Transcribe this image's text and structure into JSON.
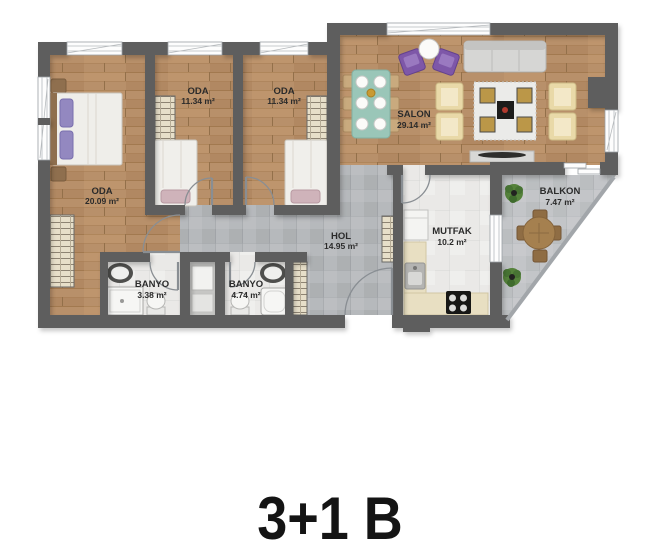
{
  "title": "3+1 B",
  "palette": {
    "wall": "#5e5e5e",
    "wood_floor": "#b8906a",
    "tile_gray": "#b6b9bc",
    "tile_light": "#eae9e7",
    "label_color": "#2b2b2b",
    "accent_purple": "#7e57a8",
    "accent_teal": "#9ac6b8"
  },
  "rooms": [
    {
      "name": "ODA",
      "area": "20.09 m²"
    },
    {
      "name": "ODA",
      "area": "11.34 m²"
    },
    {
      "name": "ODA",
      "area": "11.34 m²"
    },
    {
      "name": "SALON",
      "area": "29.14 m²"
    },
    {
      "name": "HOL",
      "area": "14.95 m²"
    },
    {
      "name": "MUTFAK",
      "area": "10.2 m²"
    },
    {
      "name": "BALKON",
      "area": "7.47 m²"
    },
    {
      "name": "BANYO",
      "area": "3.38 m²"
    },
    {
      "name": "BANYO",
      "area": "4.74 m²"
    }
  ]
}
